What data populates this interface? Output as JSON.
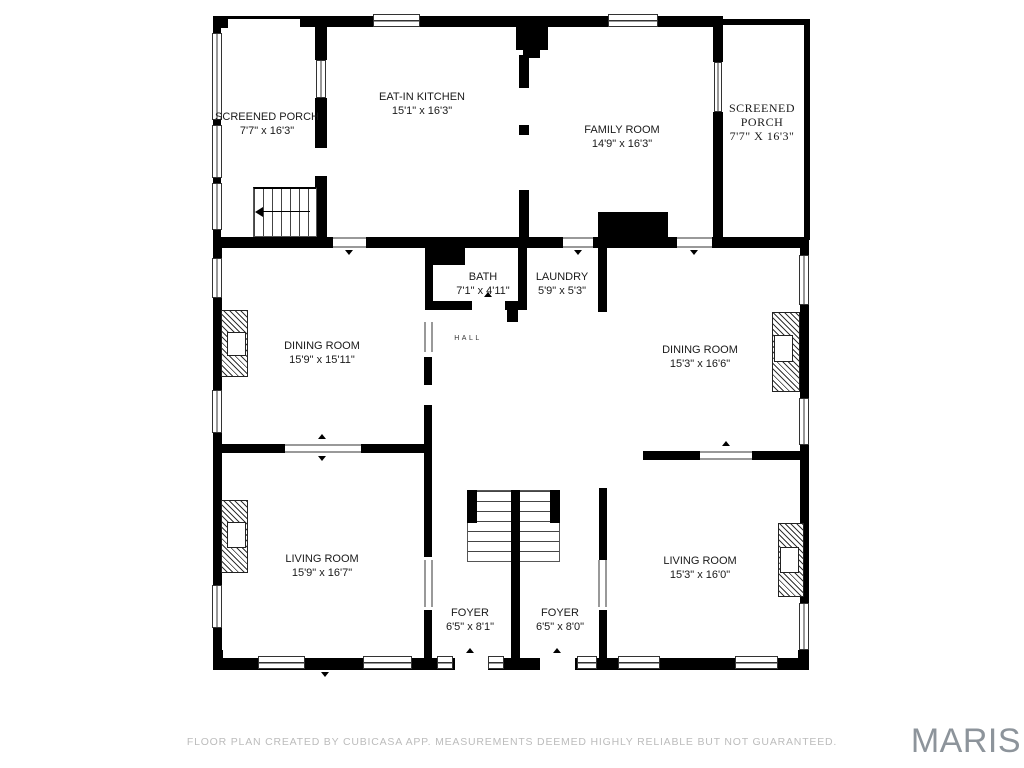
{
  "rooms": {
    "screened_porch_left": {
      "name": "SCREENED PORCH",
      "dims": "7'7\" x 16'3\""
    },
    "eat_in_kitchen": {
      "name": "EAT-IN KITCHEN",
      "dims": "15'1\" x 16'3\""
    },
    "family_room": {
      "name": "FAMILY ROOM",
      "dims": "14'9\" x 16'3\""
    },
    "screened_porch_right": {
      "name_line1": "SCREENED",
      "name_line2": "PORCH",
      "dims": "7'7\" X 16'3\""
    },
    "bath": {
      "name": "BATH",
      "dims": "7'1\" x 4'11\""
    },
    "laundry": {
      "name": "LAUNDRY",
      "dims": "5'9\" x 5'3\""
    },
    "hall": {
      "name": "HALL"
    },
    "dining_room_left": {
      "name": "DINING ROOM",
      "dims": "15'9\" x 15'11\""
    },
    "dining_room_right": {
      "name": "DINING ROOM",
      "dims": "15'3\" x 16'6\""
    },
    "living_room_left": {
      "name": "LIVING ROOM",
      "dims": "15'9\" x 16'7\""
    },
    "living_room_right": {
      "name": "LIVING ROOM",
      "dims": "15'3\" x 16'0\""
    },
    "foyer_left": {
      "name": "FOYER",
      "dims": "6'5\" x 8'1\""
    },
    "foyer_right": {
      "name": "FOYER",
      "dims": "6'5\" x 8'0\""
    }
  },
  "footer": {
    "text": "FLOOR PLAN CREATED BY CUBICASA APP. MEASUREMENTS DEEMED HIGHLY RELIABLE BUT NOT GUARANTEED."
  },
  "watermark": {
    "text": "MARIS"
  },
  "colors": {
    "wall": "#000000",
    "footer_text": "#bcbcbc",
    "watermark": "#8d949b"
  }
}
